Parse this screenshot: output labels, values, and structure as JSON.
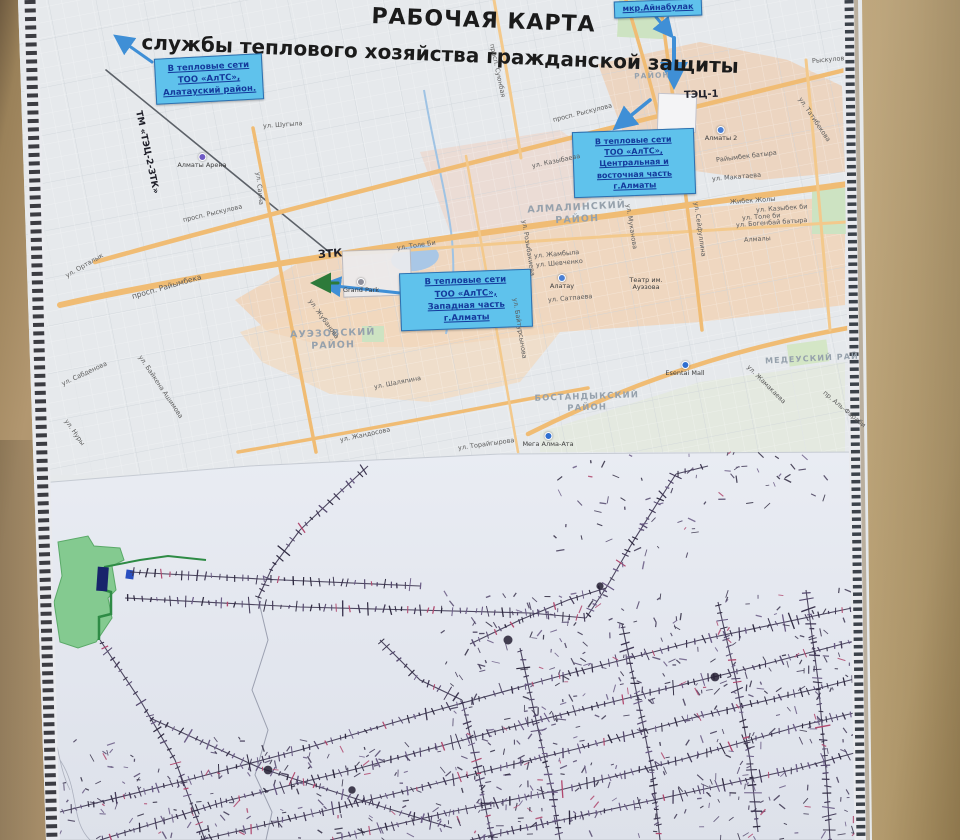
{
  "poster": {
    "title_line1": "РАБОЧАЯ КАРТА",
    "title_line2": "службы теплового хозяйства гражданской защиты"
  },
  "colors": {
    "callout_bg": "#5fc2ec",
    "callout_text": "#143a9c",
    "wall": "#b29770",
    "district_text": "#96a1ac",
    "road_orange": "#f0bc74",
    "paper": "#e3e7ef",
    "net_ink": "#3c3550",
    "net_red": "#b0486e",
    "water": "#a9c7e6",
    "park": "#cde3c2",
    "arrow_blue": "#3f8fd6",
    "site_green": "#84ca90",
    "building_navy": "#18246b"
  },
  "callouts": [
    {
      "id": "alatau",
      "x": 155,
      "y": 56,
      "w": 108,
      "h": 46,
      "rot": -3,
      "fs": 8.5,
      "lh": 1.45,
      "lines": [
        "В тепловые сети",
        "ТОО «АлТС»,",
        "Алатауский район."
      ]
    },
    {
      "id": "ainabulak",
      "x": 614,
      "y": 0,
      "w": 88,
      "h": 17,
      "rot": -2,
      "fs": 8,
      "lh": 1.1,
      "lines": [
        "мкр.Айнабулак"
      ]
    },
    {
      "id": "central",
      "x": 573,
      "y": 130,
      "w": 122,
      "h": 66,
      "rot": -2,
      "fs": 8,
      "lh": 1.4,
      "lines": [
        "В тепловые сети",
        "ТОО «АлТС»,",
        "Центральная и",
        "восточная часть",
        "г.Алматы"
      ]
    },
    {
      "id": "west",
      "x": 400,
      "y": 271,
      "w": 132,
      "h": 58,
      "rot": -2,
      "fs": 8.5,
      "lh": 1.45,
      "lines": [
        "В тепловые сети",
        "ТОО «АлТС»,",
        "Западная часть",
        "г.Алматы"
      ]
    }
  ],
  "districts": [
    {
      "t": "АЛМАЛИНСКИЙ\nРАЙОН",
      "x": 577,
      "y": 202,
      "r": -3,
      "fs": 9.5
    },
    {
      "t": "АУЭЗОВСКИЙ\nРАЙОН",
      "x": 333,
      "y": 328,
      "r": -2,
      "fs": 9.5
    },
    {
      "t": "БОСТАНДЫКСКИЙ\nРАЙОН",
      "x": 587,
      "y": 392,
      "r": -2,
      "fs": 8.5
    },
    {
      "t": "МЕДЕУСКИЙ РАЙ",
      "x": 812,
      "y": 354,
      "r": -3,
      "fs": 8
    },
    {
      "t": "РАЙОН",
      "x": 652,
      "y": 71,
      "r": -2,
      "fs": 7.5
    }
  ],
  "special_labels": [
    {
      "t": "ЗТК",
      "x": 318,
      "y": 248,
      "r": -4,
      "fs": 11
    },
    {
      "t": "ТЭЦ-1",
      "x": 684,
      "y": 90,
      "r": -2,
      "fs": 10
    },
    {
      "t": "ТМ «ТЭЦ-2-ЗТК»",
      "x": 138,
      "y": 106,
      "r": 78,
      "fs": 9
    }
  ],
  "poi": [
    {
      "t": "Алматы Арена",
      "x": 202,
      "y": 164,
      "dot": "#6f5bc5",
      "dy": 153
    },
    {
      "t": "Grand Park",
      "x": 361,
      "y": 289,
      "dot": "#8f8f9b",
      "dy": 278
    },
    {
      "t": "Алматы 2",
      "x": 721,
      "y": 137,
      "dot": "#4a7fd4",
      "dy": 126
    },
    {
      "t": "Esentai Mall",
      "x": 685,
      "y": 373,
      "dot": "#2f6fd0",
      "dy": 361
    },
    {
      "t": "Мега Алма-Ата",
      "x": 548,
      "y": 444,
      "dot": "#2f6fd0",
      "dy": 432
    },
    {
      "t": "Алатау",
      "x": 562,
      "y": 285,
      "dot": "#4a7fd4",
      "dy": 274
    },
    {
      "t": "Театр им.\nАуэзова",
      "x": 646,
      "y": 277
    }
  ],
  "streets": [
    {
      "t": "просп. Райымбека",
      "x": 132,
      "y": 292,
      "r": -16,
      "fs": 7.5
    },
    {
      "t": "просп. Рыскулова",
      "x": 183,
      "y": 216,
      "r": -13
    },
    {
      "t": "просп. Рыскулова",
      "x": 553,
      "y": 116,
      "r": -14
    },
    {
      "t": "ул. Шугыла",
      "x": 263,
      "y": 122,
      "r": -4
    },
    {
      "t": "ул. Орталык",
      "x": 66,
      "y": 272,
      "r": -30
    },
    {
      "t": "ул. Сабденова",
      "x": 62,
      "y": 380,
      "r": -25
    },
    {
      "t": "ул. Байкена Ашимова",
      "x": 140,
      "y": 352,
      "r": 56
    },
    {
      "t": "ул. Нуры",
      "x": 66,
      "y": 416,
      "r": 55
    },
    {
      "t": "ул. Жубанова",
      "x": 310,
      "y": 296,
      "r": 54
    },
    {
      "t": "ул. Толе Би",
      "x": 397,
      "y": 244,
      "r": -8
    },
    {
      "t": "ул. Казыбаева",
      "x": 532,
      "y": 162,
      "r": -12
    },
    {
      "t": "ул. Шаляпина",
      "x": 374,
      "y": 383,
      "r": -11
    },
    {
      "t": "ул. Жандосова",
      "x": 340,
      "y": 436,
      "r": -12
    },
    {
      "t": "ул. Торайгырова",
      "x": 458,
      "y": 444,
      "r": -8
    },
    {
      "t": "ул. Сатпаева",
      "x": 548,
      "y": 296,
      "r": -5
    },
    {
      "t": "ул. Жамбыла",
      "x": 534,
      "y": 252,
      "r": -5
    },
    {
      "t": "ул. Шевченко",
      "x": 536,
      "y": 261,
      "r": -5
    },
    {
      "t": "ул. Макатаева",
      "x": 712,
      "y": 175,
      "r": -5
    },
    {
      "t": "Райымбек батыра",
      "x": 716,
      "y": 156,
      "r": -7
    },
    {
      "t": "Жибек Жолы",
      "x": 730,
      "y": 198,
      "r": -4
    },
    {
      "t": "ул. Казыбек би",
      "x": 756,
      "y": 206,
      "r": -4
    },
    {
      "t": "ул. Толе би",
      "x": 742,
      "y": 214,
      "r": -4
    },
    {
      "t": "ул. Богенбай батыра",
      "x": 736,
      "y": 221,
      "r": -4
    },
    {
      "t": "Алмалы",
      "x": 744,
      "y": 236,
      "r": -4
    },
    {
      "t": "ул. Татибекова",
      "x": 800,
      "y": 94,
      "r": 56
    },
    {
      "t": "Рыскулов",
      "x": 812,
      "y": 57,
      "r": -5
    },
    {
      "t": "ул. Розыбакиева",
      "x": 524,
      "y": 216,
      "r": 81
    },
    {
      "t": "ул. Муканова",
      "x": 628,
      "y": 200,
      "r": 81
    },
    {
      "t": "ул. Сейфуллина",
      "x": 696,
      "y": 198,
      "r": 82
    },
    {
      "t": "ул. Байтурсынова",
      "x": 515,
      "y": 294,
      "r": 81
    },
    {
      "t": "ул. Саина",
      "x": 258,
      "y": 168,
      "r": 84
    },
    {
      "t": "просп. Суюнбая",
      "x": 492,
      "y": 40,
      "r": 78
    },
    {
      "t": "ул. Жамакаева",
      "x": 748,
      "y": 362,
      "r": 45
    },
    {
      "t": "пр. Аль-Фараби",
      "x": 824,
      "y": 388,
      "r": 40
    }
  ],
  "schematic": {
    "seed": 20,
    "tick_spacing": 5.5,
    "trunks": [
      {
        "pts": [
          [
            300,
            530
          ],
          [
            272,
            568
          ],
          [
            258,
            598
          ]
        ]
      },
      {
        "pts": [
          [
            300,
            530
          ],
          [
            340,
            492
          ],
          [
            368,
            466
          ]
        ]
      },
      {
        "pts": [
          [
            130,
            572
          ],
          [
            260,
            579
          ],
          [
            420,
            586
          ]
        ]
      },
      {
        "pts": [
          [
            125,
            598
          ],
          [
            300,
            607
          ],
          [
            530,
            613
          ]
        ]
      },
      {
        "pts": [
          [
            530,
            613
          ],
          [
            586,
            618
          ]
        ]
      },
      {
        "pts": [
          [
            100,
            640
          ],
          [
            140,
            700
          ],
          [
            175,
            760
          ],
          [
            205,
            840
          ]
        ]
      },
      {
        "pts": [
          [
            150,
            718
          ],
          [
            260,
            768
          ],
          [
            360,
            800
          ],
          [
            452,
            828
          ]
        ]
      },
      {
        "pts": [
          [
            60,
            812
          ],
          [
            180,
            782
          ],
          [
            300,
            750
          ],
          [
            430,
            712
          ],
          [
            560,
            676
          ],
          [
            700,
            640
          ],
          [
            852,
            608
          ]
        ]
      },
      {
        "pts": [
          [
            100,
            840
          ],
          [
            230,
            800
          ],
          [
            360,
            768
          ],
          [
            500,
            730
          ],
          [
            620,
            700
          ],
          [
            750,
            668
          ],
          [
            858,
            640
          ]
        ]
      },
      {
        "pts": [
          [
            200,
            840
          ],
          [
            320,
            812
          ],
          [
            450,
            780
          ],
          [
            580,
            748
          ],
          [
            700,
            716
          ],
          [
            820,
            688
          ],
          [
            858,
            678
          ]
        ]
      },
      {
        "pts": [
          [
            330,
            840
          ],
          [
            450,
            812
          ],
          [
            560,
            790
          ],
          [
            680,
            760
          ],
          [
            800,
            726
          ],
          [
            858,
            712
          ]
        ]
      },
      {
        "pts": [
          [
            470,
            840
          ],
          [
            580,
            816
          ],
          [
            700,
            790
          ],
          [
            800,
            768
          ],
          [
            858,
            752
          ]
        ]
      },
      {
        "pts": [
          [
            520,
            648
          ],
          [
            536,
            720
          ],
          [
            552,
            790
          ],
          [
            560,
            840
          ]
        ]
      },
      {
        "pts": [
          [
            622,
            624
          ],
          [
            638,
            700
          ],
          [
            652,
            770
          ],
          [
            660,
            840
          ]
        ]
      },
      {
        "pts": [
          [
            718,
            602
          ],
          [
            736,
            680
          ],
          [
            750,
            760
          ],
          [
            758,
            832
          ]
        ]
      },
      {
        "pts": [
          [
            806,
            590
          ],
          [
            818,
            680
          ],
          [
            826,
            770
          ],
          [
            830,
            840
          ]
        ]
      },
      {
        "pts": [
          [
            462,
            700
          ],
          [
            478,
            770
          ],
          [
            492,
            840
          ]
        ]
      },
      {
        "pts": [
          [
            470,
            644
          ],
          [
            520,
            620
          ],
          [
            568,
            600
          ],
          [
            606,
            588
          ]
        ]
      },
      {
        "pts": [
          [
            606,
            588
          ],
          [
            634,
            540
          ],
          [
            658,
            502
          ],
          [
            676,
            474
          ]
        ]
      },
      {
        "pts": [
          [
            676,
            474
          ],
          [
            708,
            466
          ]
        ]
      },
      {
        "pts": [
          [
            380,
            640
          ],
          [
            420,
            680
          ],
          [
            462,
            700
          ]
        ]
      },
      {
        "pts": [
          [
            586,
            618
          ],
          [
            606,
            588
          ]
        ]
      }
    ],
    "river": {
      "pts": [
        [
          258,
          598
        ],
        [
          268,
          640
        ],
        [
          252,
          690
        ],
        [
          268,
          730
        ],
        [
          255,
          775
        ],
        [
          272,
          812
        ],
        [
          266,
          840
        ]
      ]
    },
    "scatter": [
      {
        "x": 440,
        "y": 590,
        "w": 418,
        "h": 250,
        "n": 430
      },
      {
        "x": 60,
        "y": 735,
        "w": 380,
        "h": 105,
        "n": 150
      },
      {
        "x": 555,
        "y": 455,
        "w": 150,
        "h": 115,
        "n": 42
      },
      {
        "x": 715,
        "y": 450,
        "w": 115,
        "h": 62,
        "n": 28
      }
    ],
    "blobs": [
      [
        352,
        790
      ],
      [
        715,
        677
      ],
      [
        600,
        586
      ],
      [
        508,
        640
      ],
      [
        268,
        770
      ]
    ]
  }
}
